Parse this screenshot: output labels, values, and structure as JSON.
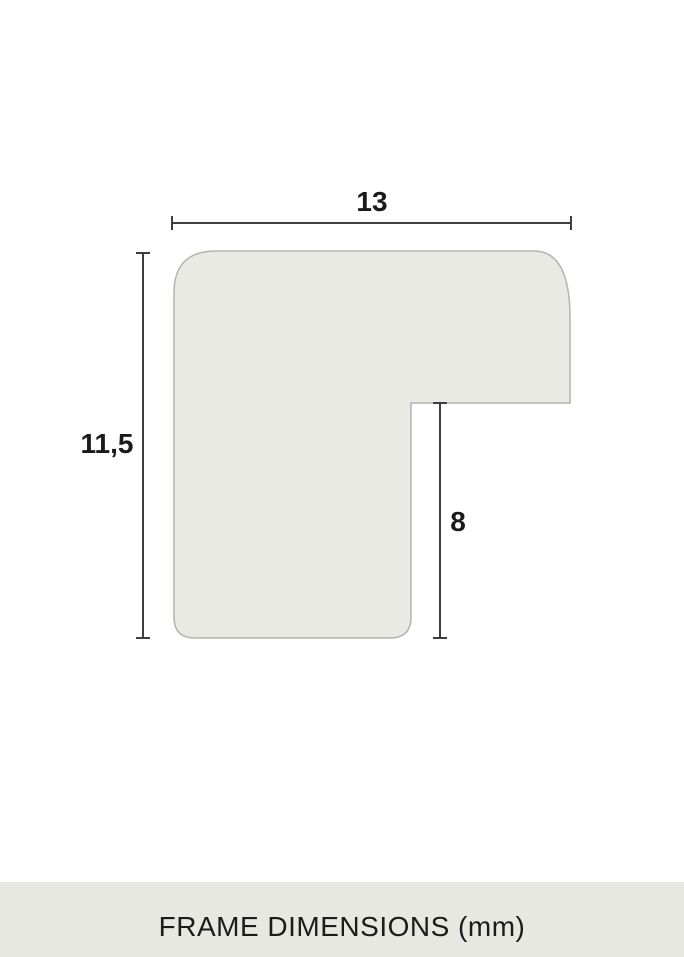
{
  "diagram": {
    "title": "frame profile cross-section",
    "dimensions": {
      "width_top": "13",
      "height_left": "11,5",
      "rabbet_height": "8"
    },
    "caption": "FRAME DIMENSIONS (mm)"
  },
  "colors": {
    "background": "#FFFFFF",
    "profile_fill": "#EAEAE5",
    "profile_outline": "#B4B4AF",
    "dimension_line": "#3F3F3F",
    "label_text": "#1A1A1A",
    "caption_bar_bg": "#E8E8E3",
    "caption_text": "#1C1C1C"
  }
}
